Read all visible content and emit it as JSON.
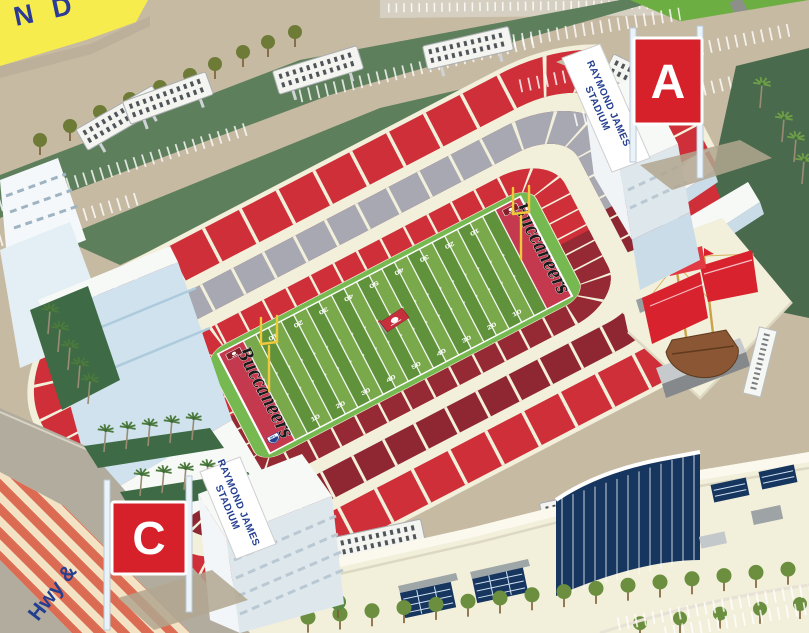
{
  "signs": {
    "gate_a": "A",
    "gate_c": "C",
    "banner_ne": {
      "line1": "RAYMOND JAMES",
      "line2": "STADIUM"
    },
    "banner_sw": {
      "line1": "RAYMOND JAMES",
      "line2": "STADIUM"
    },
    "corner_sign_partial": "N D",
    "road_label": "Hwy &"
  },
  "field": {
    "yard_numbers": [
      "10",
      "20",
      "30",
      "40",
      "50",
      "40",
      "30",
      "20",
      "10"
    ],
    "endzone_left": "Buccaneers",
    "endzone_right": "Buccaneers",
    "nfl_label": "NFL"
  },
  "icons": [
    "pirate-ship-icon",
    "buccaneers-flag-icon",
    "nfl-shield-icon",
    "palm-tree-icon",
    "tree-icon",
    "stadium-floodlight-icon",
    "goal-post-icon"
  ],
  "colors": {
    "seat_red": "#CE2F38",
    "seat_maroon": "#8E2732",
    "tier_gray": "#A8A8B2",
    "cream": "#F2EFDB",
    "apron_green": "#77B951",
    "stripe_light": "#7AA94C",
    "stripe_dark": "#5F923B",
    "endzone_red": "#C4394D",
    "sign_red": "#D6212B",
    "banner_blue": "#243E90",
    "yellow_sign": "#F6EC4E",
    "glass_blue": "#16365F",
    "grass_bright": "#6CAE41",
    "grass_dark": "#4A6A4D",
    "grass_sage": "#5E7F5C",
    "grass_median": "#3E6B45",
    "pavement": "#C7BAA3",
    "ramp_blue": "#CFE2EE",
    "sail_red": "#D8232F"
  }
}
